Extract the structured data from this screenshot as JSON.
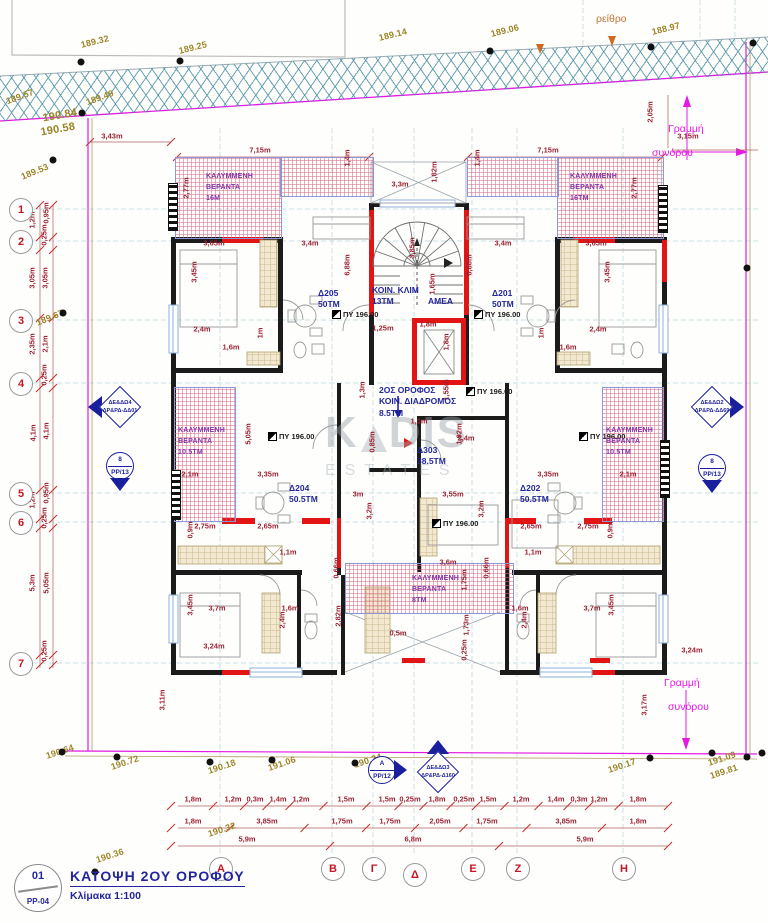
{
  "title_block": {
    "detail_number": "01",
    "sheet": "PP-04",
    "title": "ΚΑΤΟΨΗ 2ΟΥ ΟΡΟΦΟΥ",
    "scale": "Κλίμακα 1:100"
  },
  "watermark": {
    "k": "K",
    "dis": "DIS",
    "sub": "ESTATES"
  },
  "road_label": {
    "t": "ρείθρο",
    "x": 596,
    "y": 14
  },
  "colors": {
    "wall": "#1b1b1b",
    "new_wall": "#e21414",
    "boundary": "#e41ae4",
    "dim": "#9c2233",
    "elevation": "#9c8427",
    "room": "#23269b",
    "veranda": "#8435a8",
    "road_hatch": "#468ca0"
  },
  "boundary_notes": [
    {
      "t": "Γραμμή",
      "x": 668,
      "y": 124
    },
    {
      "t": "συνόρου",
      "x": 652,
      "y": 148
    },
    {
      "t": "Γραμμή",
      "x": 664,
      "y": 678
    },
    {
      "t": "συνόρου",
      "x": 668,
      "y": 702
    }
  ],
  "grid_rows": [
    {
      "label": "1",
      "y": 209
    },
    {
      "label": "2",
      "y": 241
    },
    {
      "label": "3",
      "y": 320
    },
    {
      "label": "4",
      "y": 383
    },
    {
      "label": "5",
      "y": 493
    },
    {
      "label": "6",
      "y": 522
    },
    {
      "label": "7",
      "y": 663
    }
  ],
  "grid_cols": [
    {
      "label": "Α",
      "x": 220,
      "y": 868
    },
    {
      "label": "Β",
      "x": 332,
      "y": 868
    },
    {
      "label": "Γ",
      "x": 373,
      "y": 868
    },
    {
      "label": "Δ",
      "x": 414,
      "y": 874
    },
    {
      "label": "Ε",
      "x": 472,
      "y": 868
    },
    {
      "label": "Ζ",
      "x": 517,
      "y": 868
    },
    {
      "label": "Η",
      "x": 623,
      "y": 868
    }
  ],
  "rooms": [
    {
      "lines": [
        "Δ205",
        "50ΤΜ"
      ],
      "x": 318,
      "y": 288
    },
    {
      "lines": [
        "Δ201",
        "50ΤΜ"
      ],
      "x": 492,
      "y": 288
    },
    {
      "lines": [
        "ΚΟΙΝ. ΚΛΙΜ",
        "13ΤΜ"
      ],
      "x": 372,
      "y": 285
    },
    {
      "lines": [
        "ΑΜΕΑ"
      ],
      "x": 428,
      "y": 296
    },
    {
      "lines": [
        "2ΟΣ ΟΡΟΦΟΣ",
        "ΚΟΙΝ. ΔΙΑΔΡΟΜΟΣ",
        "8.5ΤΜ"
      ],
      "x": 379,
      "y": 385
    },
    {
      "lines": [
        "Δ303",
        "38.5ΤΜ"
      ],
      "x": 417,
      "y": 445
    },
    {
      "lines": [
        "Δ204",
        "50.5ΤΜ"
      ],
      "x": 289,
      "y": 483
    },
    {
      "lines": [
        "Δ202",
        "50.5ΤΜ"
      ],
      "x": 520,
      "y": 483
    }
  ],
  "verandas": [
    {
      "lines": [
        "ΚΑΛΥΜΜΕΝΗ",
        "ΒΕΡΑΝΤΑ",
        "16Μ"
      ],
      "x": 206,
      "y": 172
    },
    {
      "lines": [
        "ΚΑΛΥΜΜΕΝΗ",
        "ΒΕΡΑΝΤΑ",
        "16ΤΜ"
      ],
      "x": 570,
      "y": 172
    },
    {
      "lines": [
        "ΚΑΛΥΜΜΕΝΗ",
        "ΒΕΡΑΝΤΑ",
        "10.5ΤΜ"
      ],
      "x": 178,
      "y": 426
    },
    {
      "lines": [
        "ΚΑΛΥΜΜΕΝΗ",
        "ΒΕΡΑΝΤΑ",
        "10.5ΤΜ"
      ],
      "x": 606,
      "y": 426
    },
    {
      "lines": [
        "ΚΑΛΥΜΜΕΝΗ",
        "ΒΕΡΑΝΤΑ",
        "8ΤΜ"
      ],
      "x": 412,
      "y": 574
    }
  ],
  "levels": [
    {
      "t": "ΠΥ 196.00",
      "x": 332,
      "y": 310
    },
    {
      "t": "ΠΥ 196.00",
      "x": 474,
      "y": 310
    },
    {
      "t": "ΠΥ 196.00",
      "x": 268,
      "y": 432
    },
    {
      "t": "ΠΥ 196.00",
      "x": 579,
      "y": 432
    },
    {
      "t": "ΠΥ 196.00",
      "x": 466,
      "y": 387
    },
    {
      "t": "ΠΥ 196.00",
      "x": 432,
      "y": 519
    }
  ],
  "elevations": [
    {
      "t": "189.32",
      "x": 95,
      "y": 42,
      "r": -14
    },
    {
      "t": "189.25",
      "x": 193,
      "y": 48,
      "r": -14
    },
    {
      "t": "189.14",
      "x": 393,
      "y": 35,
      "r": -14
    },
    {
      "t": "189.06",
      "x": 505,
      "y": 31,
      "r": -14
    },
    {
      "t": "188.97",
      "x": 666,
      "y": 29,
      "r": -14
    },
    {
      "t": "189.57",
      "x": 20,
      "y": 97,
      "r": -20
    },
    {
      "t": "189.49",
      "x": 100,
      "y": 98,
      "r": -20
    },
    {
      "t": "190.84",
      "x": 60,
      "y": 116,
      "r": -10,
      "s": 11
    },
    {
      "t": "190.58",
      "x": 58,
      "y": 130,
      "r": -10,
      "s": 11
    },
    {
      "t": "189.53",
      "x": 35,
      "y": 172,
      "r": -22
    },
    {
      "t": "189.67",
      "x": 50,
      "y": 318,
      "r": -22
    },
    {
      "t": "190.64",
      "x": 60,
      "y": 752,
      "r": -18
    },
    {
      "t": "190.72",
      "x": 125,
      "y": 763,
      "r": -18
    },
    {
      "t": "190.18",
      "x": 222,
      "y": 767,
      "r": -18
    },
    {
      "t": "191.06",
      "x": 282,
      "y": 764,
      "r": -18
    },
    {
      "t": "190.24",
      "x": 368,
      "y": 761,
      "r": -18
    },
    {
      "t": "190.32",
      "x": 222,
      "y": 830,
      "r": -18
    },
    {
      "t": "190.36",
      "x": 110,
      "y": 856,
      "r": -18
    },
    {
      "t": "190.17",
      "x": 622,
      "y": 766,
      "r": -18
    },
    {
      "t": "191.09",
      "x": 722,
      "y": 759,
      "r": -18
    },
    {
      "t": "189.81",
      "x": 724,
      "y": 772,
      "r": -18
    }
  ],
  "dims": [
    {
      "t": "3,43m",
      "x": 112,
      "y": 136
    },
    {
      "t": "7,15m",
      "x": 260,
      "y": 150
    },
    {
      "t": "7,15m",
      "x": 548,
      "y": 150
    },
    {
      "t": "3,3m",
      "x": 400,
      "y": 184
    },
    {
      "t": "1,82m",
      "x": 434,
      "y": 172,
      "v": 1
    },
    {
      "t": "1,4m",
      "x": 347,
      "y": 158,
      "v": 1
    },
    {
      "t": "1,4m",
      "x": 477,
      "y": 158,
      "v": 1
    },
    {
      "t": "2,77m",
      "x": 186,
      "y": 188,
      "v": 1
    },
    {
      "t": "2,77m",
      "x": 634,
      "y": 188,
      "v": 1
    },
    {
      "t": "2,05m",
      "x": 650,
      "y": 112,
      "v": 1
    },
    {
      "t": "3,15m",
      "x": 688,
      "y": 136
    },
    {
      "t": "3,65m",
      "x": 214,
      "y": 243
    },
    {
      "t": "3,4m",
      "x": 310,
      "y": 243
    },
    {
      "t": "3,4m",
      "x": 503,
      "y": 243
    },
    {
      "t": "3,65m",
      "x": 596,
      "y": 243
    },
    {
      "t": "3,45m",
      "x": 194,
      "y": 272,
      "v": 1
    },
    {
      "t": "3,45m",
      "x": 607,
      "y": 272,
      "v": 1
    },
    {
      "t": "6,88m",
      "x": 347,
      "y": 265,
      "v": 1
    },
    {
      "t": "6,88m",
      "x": 469,
      "y": 265,
      "v": 1
    },
    {
      "t": "3,85m",
      "x": 412,
      "y": 248,
      "v": 1
    },
    {
      "t": "2,4m",
      "x": 202,
      "y": 329
    },
    {
      "t": "2,4m",
      "x": 598,
      "y": 329
    },
    {
      "t": "1m",
      "x": 260,
      "y": 333,
      "v": 1
    },
    {
      "t": "1m",
      "x": 541,
      "y": 333,
      "v": 1
    },
    {
      "t": "1,6m",
      "x": 231,
      "y": 347
    },
    {
      "t": "1,6m",
      "x": 568,
      "y": 347
    },
    {
      "t": "1,25m",
      "x": 383,
      "y": 328
    },
    {
      "t": "1,8m",
      "x": 428,
      "y": 324
    },
    {
      "t": "1,8m",
      "x": 446,
      "y": 342,
      "v": 1
    },
    {
      "t": "1,65m",
      "x": 432,
      "y": 284,
      "v": 1
    },
    {
      "t": "1,3m",
      "x": 362,
      "y": 390,
      "v": 1
    },
    {
      "t": "1,55m",
      "x": 446,
      "y": 390,
      "v": 1
    },
    {
      "t": "1,1m",
      "x": 419,
      "y": 421
    },
    {
      "t": "1,92m",
      "x": 459,
      "y": 434,
      "v": 1
    },
    {
      "t": "2,4m",
      "x": 466,
      "y": 438
    },
    {
      "t": "0,85m",
      "x": 372,
      "y": 442,
      "v": 1
    },
    {
      "t": "3m",
      "x": 358,
      "y": 494
    },
    {
      "t": "3,2m",
      "x": 369,
      "y": 511,
      "v": 1
    },
    {
      "t": "3,55m",
      "x": 453,
      "y": 494
    },
    {
      "t": "3,2m",
      "x": 481,
      "y": 509,
      "v": 1
    },
    {
      "t": "2,1m",
      "x": 190,
      "y": 474
    },
    {
      "t": "2,1m",
      "x": 628,
      "y": 474
    },
    {
      "t": "3,35m",
      "x": 268,
      "y": 474
    },
    {
      "t": "3,35m",
      "x": 548,
      "y": 474
    },
    {
      "t": "5,05m",
      "x": 248,
      "y": 434,
      "v": 1
    },
    {
      "t": "2,75m",
      "x": 205,
      "y": 526
    },
    {
      "t": "2,65m",
      "x": 268,
      "y": 526
    },
    {
      "t": "2,65m",
      "x": 531,
      "y": 526
    },
    {
      "t": "2,75m",
      "x": 588,
      "y": 526
    },
    {
      "t": "0,9m",
      "x": 190,
      "y": 530,
      "v": 1
    },
    {
      "t": "0,9m",
      "x": 610,
      "y": 530,
      "v": 1
    },
    {
      "t": "1,1m",
      "x": 288,
      "y": 552
    },
    {
      "t": "1,1m",
      "x": 533,
      "y": 552
    },
    {
      "t": "3,45m",
      "x": 190,
      "y": 605,
      "v": 1
    },
    {
      "t": "3,7m",
      "x": 217,
      "y": 608
    },
    {
      "t": "3,7m",
      "x": 592,
      "y": 608
    },
    {
      "t": "3,45m",
      "x": 611,
      "y": 605,
      "v": 1
    },
    {
      "t": "2,4m",
      "x": 282,
      "y": 620,
      "v": 1
    },
    {
      "t": "2,4m",
      "x": 524,
      "y": 620,
      "v": 1
    },
    {
      "t": "1,6m",
      "x": 290,
      "y": 608
    },
    {
      "t": "1,6m",
      "x": 520,
      "y": 608
    },
    {
      "t": "2,82m",
      "x": 338,
      "y": 616,
      "v": 1
    },
    {
      "t": "0,66m",
      "x": 336,
      "y": 568,
      "v": 1
    },
    {
      "t": "0,66m",
      "x": 486,
      "y": 568,
      "v": 1
    },
    {
      "t": "3,6m",
      "x": 448,
      "y": 562
    },
    {
      "t": "1,75m",
      "x": 464,
      "y": 580,
      "v": 1
    },
    {
      "t": "1,73m",
      "x": 466,
      "y": 625,
      "v": 1
    },
    {
      "t": "0,25m",
      "x": 464,
      "y": 650,
      "v": 1
    },
    {
      "t": "0,5m",
      "x": 398,
      "y": 633
    },
    {
      "t": "3,24m",
      "x": 214,
      "y": 646
    },
    {
      "t": "3,24m",
      "x": 692,
      "y": 650
    },
    {
      "t": "3,17m",
      "x": 644,
      "y": 705,
      "v": 1
    },
    {
      "t": "3,11m",
      "x": 162,
      "y": 700,
      "v": 1
    },
    {
      "t": "1,2m",
      "x": 32,
      "y": 220,
      "v": 1
    },
    {
      "t": "0,95m",
      "x": 46,
      "y": 213,
      "v": 1
    },
    {
      "t": "0,25m",
      "x": 44,
      "y": 235,
      "v": 1
    },
    {
      "t": "3,05m",
      "x": 32,
      "y": 278,
      "v": 1
    },
    {
      "t": "3,05m",
      "x": 45,
      "y": 278,
      "v": 1
    },
    {
      "t": "2,35m",
      "x": 32,
      "y": 344,
      "v": 1
    },
    {
      "t": "2,1m",
      "x": 45,
      "y": 344,
      "v": 1
    },
    {
      "t": "0,25m",
      "x": 44,
      "y": 375,
      "v": 1
    },
    {
      "t": "4,1m",
      "x": 33,
      "y": 433,
      "v": 1
    },
    {
      "t": "4,1m",
      "x": 46,
      "y": 431,
      "v": 1
    },
    {
      "t": "1,2m",
      "x": 32,
      "y": 500,
      "v": 1
    },
    {
      "t": "0,95m",
      "x": 46,
      "y": 493,
      "v": 1
    },
    {
      "t": "0,25m",
      "x": 44,
      "y": 518,
      "v": 1
    },
    {
      "t": "5,3m",
      "x": 32,
      "y": 583,
      "v": 1
    },
    {
      "t": "5,05m",
      "x": 46,
      "y": 583,
      "v": 1
    },
    {
      "t": "0,25m",
      "x": 44,
      "y": 651,
      "v": 1
    },
    {
      "t": "1,8m",
      "x": 193,
      "y": 799
    },
    {
      "t": "1,2m",
      "x": 233,
      "y": 799
    },
    {
      "t": "0,3m",
      "x": 255,
      "y": 799
    },
    {
      "t": "1,4m",
      "x": 278,
      "y": 799
    },
    {
      "t": "1,2m",
      "x": 301,
      "y": 799
    },
    {
      "t": "1,5m",
      "x": 346,
      "y": 799
    },
    {
      "t": "1,5m",
      "x": 387,
      "y": 799
    },
    {
      "t": "0,25m",
      "x": 410,
      "y": 799
    },
    {
      "t": "1,8m",
      "x": 437,
      "y": 799
    },
    {
      "t": "0,25m",
      "x": 464,
      "y": 799
    },
    {
      "t": "1,5m",
      "x": 488,
      "y": 799
    },
    {
      "t": "1,2m",
      "x": 521,
      "y": 799
    },
    {
      "t": "1,4m",
      "x": 556,
      "y": 799
    },
    {
      "t": "0,3m",
      "x": 579,
      "y": 799
    },
    {
      "t": "1,2m",
      "x": 599,
      "y": 799
    },
    {
      "t": "1,8m",
      "x": 638,
      "y": 799
    },
    {
      "t": "1,8m",
      "x": 193,
      "y": 821
    },
    {
      "t": "3,85m",
      "x": 267,
      "y": 821
    },
    {
      "t": "1,75m",
      "x": 342,
      "y": 821
    },
    {
      "t": "1,75m",
      "x": 390,
      "y": 821
    },
    {
      "t": "2,05m",
      "x": 440,
      "y": 821
    },
    {
      "t": "1,75m",
      "x": 487,
      "y": 821
    },
    {
      "t": "3,85m",
      "x": 566,
      "y": 821
    },
    {
      "t": "1,8m",
      "x": 638,
      "y": 821
    },
    {
      "t": "5,9m",
      "x": 247,
      "y": 839
    },
    {
      "t": "6,8m",
      "x": 413,
      "y": 839
    },
    {
      "t": "5,9m",
      "x": 585,
      "y": 839
    }
  ],
  "markers_diamond": [
    {
      "l1": "ΔΕ&ΔΩ4",
      "l2": "ΔΡ&ΡΔ-ΔΔ01",
      "x": 120,
      "y": 407,
      "dir": "left"
    },
    {
      "l1": "ΔΕ&ΔΩ2",
      "l2": "ΔΡ&ΡΔ-ΔΔ69",
      "x": 712,
      "y": 407,
      "dir": "right"
    },
    {
      "l1": "ΔΕ&ΔΩ3",
      "l2": "ΔΡ&ΡΔ-Δ160",
      "x": 438,
      "y": 772,
      "dir": "up"
    }
  ],
  "markers_circle": [
    {
      "top": "8",
      "bottom": "PP/13",
      "x": 120,
      "y": 466,
      "dir": "down"
    },
    {
      "top": "8",
      "bottom": "PP/13",
      "x": 712,
      "y": 468,
      "dir": "down"
    },
    {
      "top": "Α",
      "bottom": "PP/12",
      "x": 382,
      "y": 770,
      "dir": "right"
    }
  ]
}
